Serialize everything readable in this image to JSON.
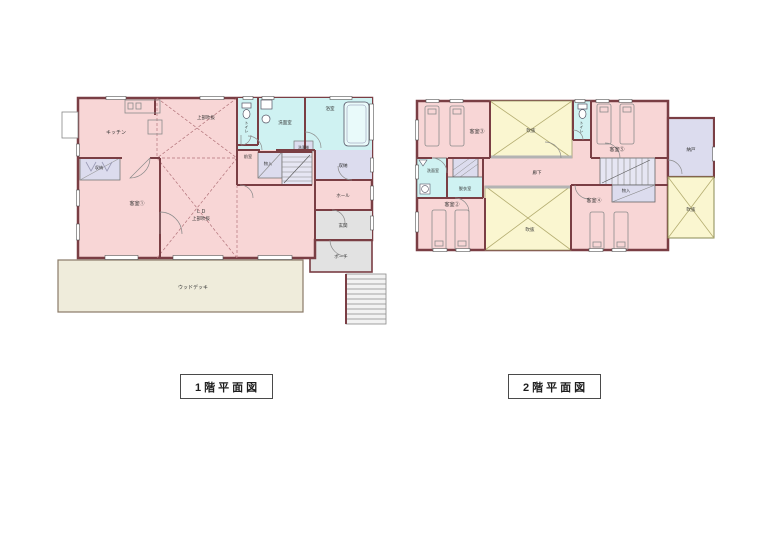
{
  "titles": {
    "floor1": "1階平面図",
    "floor2": "2階平面図"
  },
  "colors": {
    "wall": "#7a3e44",
    "room_pink": "#f8d6d6",
    "wet_cyan": "#cff2f2",
    "storage_lavender": "#dcdcee",
    "stair_lavender": "#e6e6f3",
    "void_yellow": "#faf6d0",
    "exterior_gray": "#e2e2e2",
    "deck_cream": "#efecdb"
  },
  "floor1": {
    "kitchen": "キッチン",
    "void_above": "上部吹抜",
    "toilet": "トイレ",
    "washroom": "洗面室",
    "bathroom": "浴室",
    "storage_left": "収納",
    "guest_room_1": "客室①",
    "anteroom": "前室",
    "closet": "物入",
    "washing_machine": "洗濯機",
    "storage_right": "収納",
    "hall": "ホール",
    "entrance": "玄関",
    "porch": "ポーチ",
    "living_dining": "ＬＤ",
    "living_void": "上部吹抜",
    "wood_deck": "ウッドデッキ"
  },
  "floor2": {
    "guest_room_3": "客室③",
    "void_top": "吹抜",
    "toilet": "トイレ",
    "guest_room_5": "客室⑤",
    "storage_room": "納戸",
    "corridor": "廊下",
    "washroom": "洗面室",
    "dressing_room": "脱衣室",
    "guest_room_2": "客室②",
    "guest_room_4": "客室④",
    "closet": "物入",
    "void_bottom": "吹抜",
    "void_right": "吹抜"
  }
}
